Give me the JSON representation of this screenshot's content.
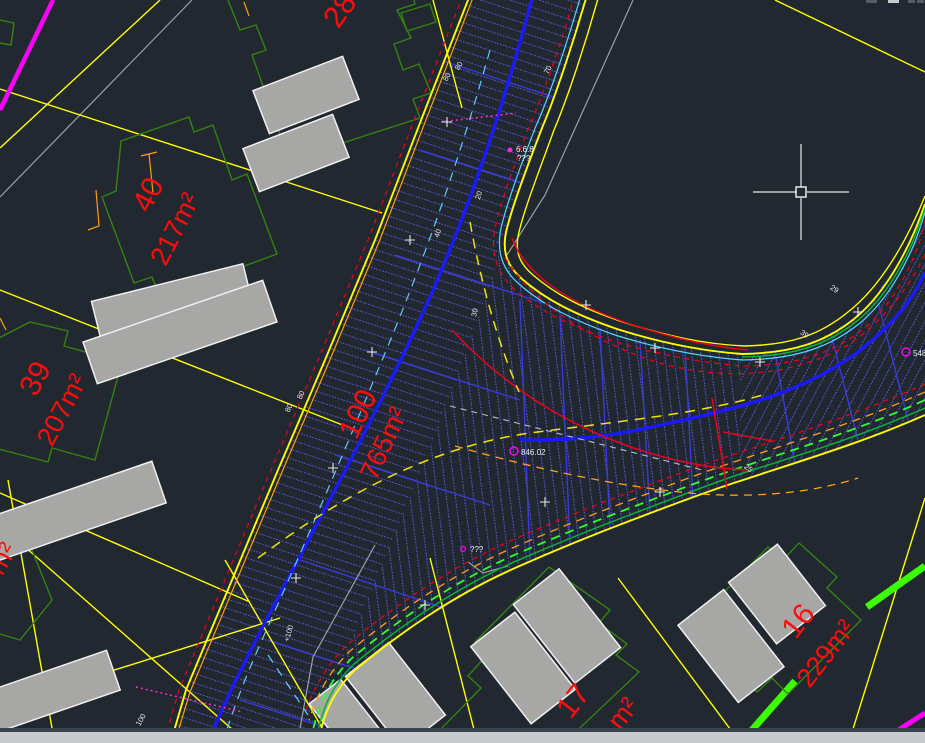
{
  "app": {
    "view": "cad-model-space",
    "theme": "dark"
  },
  "colors": {
    "background": "#212830",
    "parcel_line": "#ffff00",
    "building_envelope": "#358212",
    "building_fill": "#a7a7a5",
    "road_centerline": "#1a1aff",
    "road_hatch": "#5b5bdc",
    "curb_red": "#e8001c",
    "label_red": "#ff0d0d",
    "utility_magenta": "#ff00ff",
    "lime_marker": "#3cff00",
    "cyan_line": "#53d7ff",
    "survey_gray": "#9aa0a8",
    "orange_line": "#ffa000",
    "scrollbar": "#c9cacb"
  },
  "parcels": {
    "p28": {
      "num": "28"
    },
    "p40": {
      "num": "40",
      "area": "217m²"
    },
    "p39": {
      "num": "39",
      "area": "207m²"
    },
    "p100": {
      "num": "100",
      "area": "765m²"
    },
    "p16": {
      "num": "16",
      "area": "229m²"
    },
    "p17": {
      "num": "17",
      "area_suffix": "m²"
    },
    "left_partial": {
      "area_suffix": "m²"
    }
  },
  "stations": {
    "s80a": "80",
    "s80b": "80",
    "s80c": "80",
    "s80d": "80",
    "s70": "70",
    "s20": "20",
    "s30": "30",
    "s40": "40",
    "s25": "25",
    "s29": "29",
    "s39": "39",
    "s100": "100",
    "s100p": "+100"
  },
  "annotations": {
    "a846": "846.02",
    "a548": "548",
    "a668": "6.6.8",
    "q1": "???",
    "q2": "???"
  },
  "cursor": {
    "type": "crosshair-with-pickbox"
  }
}
